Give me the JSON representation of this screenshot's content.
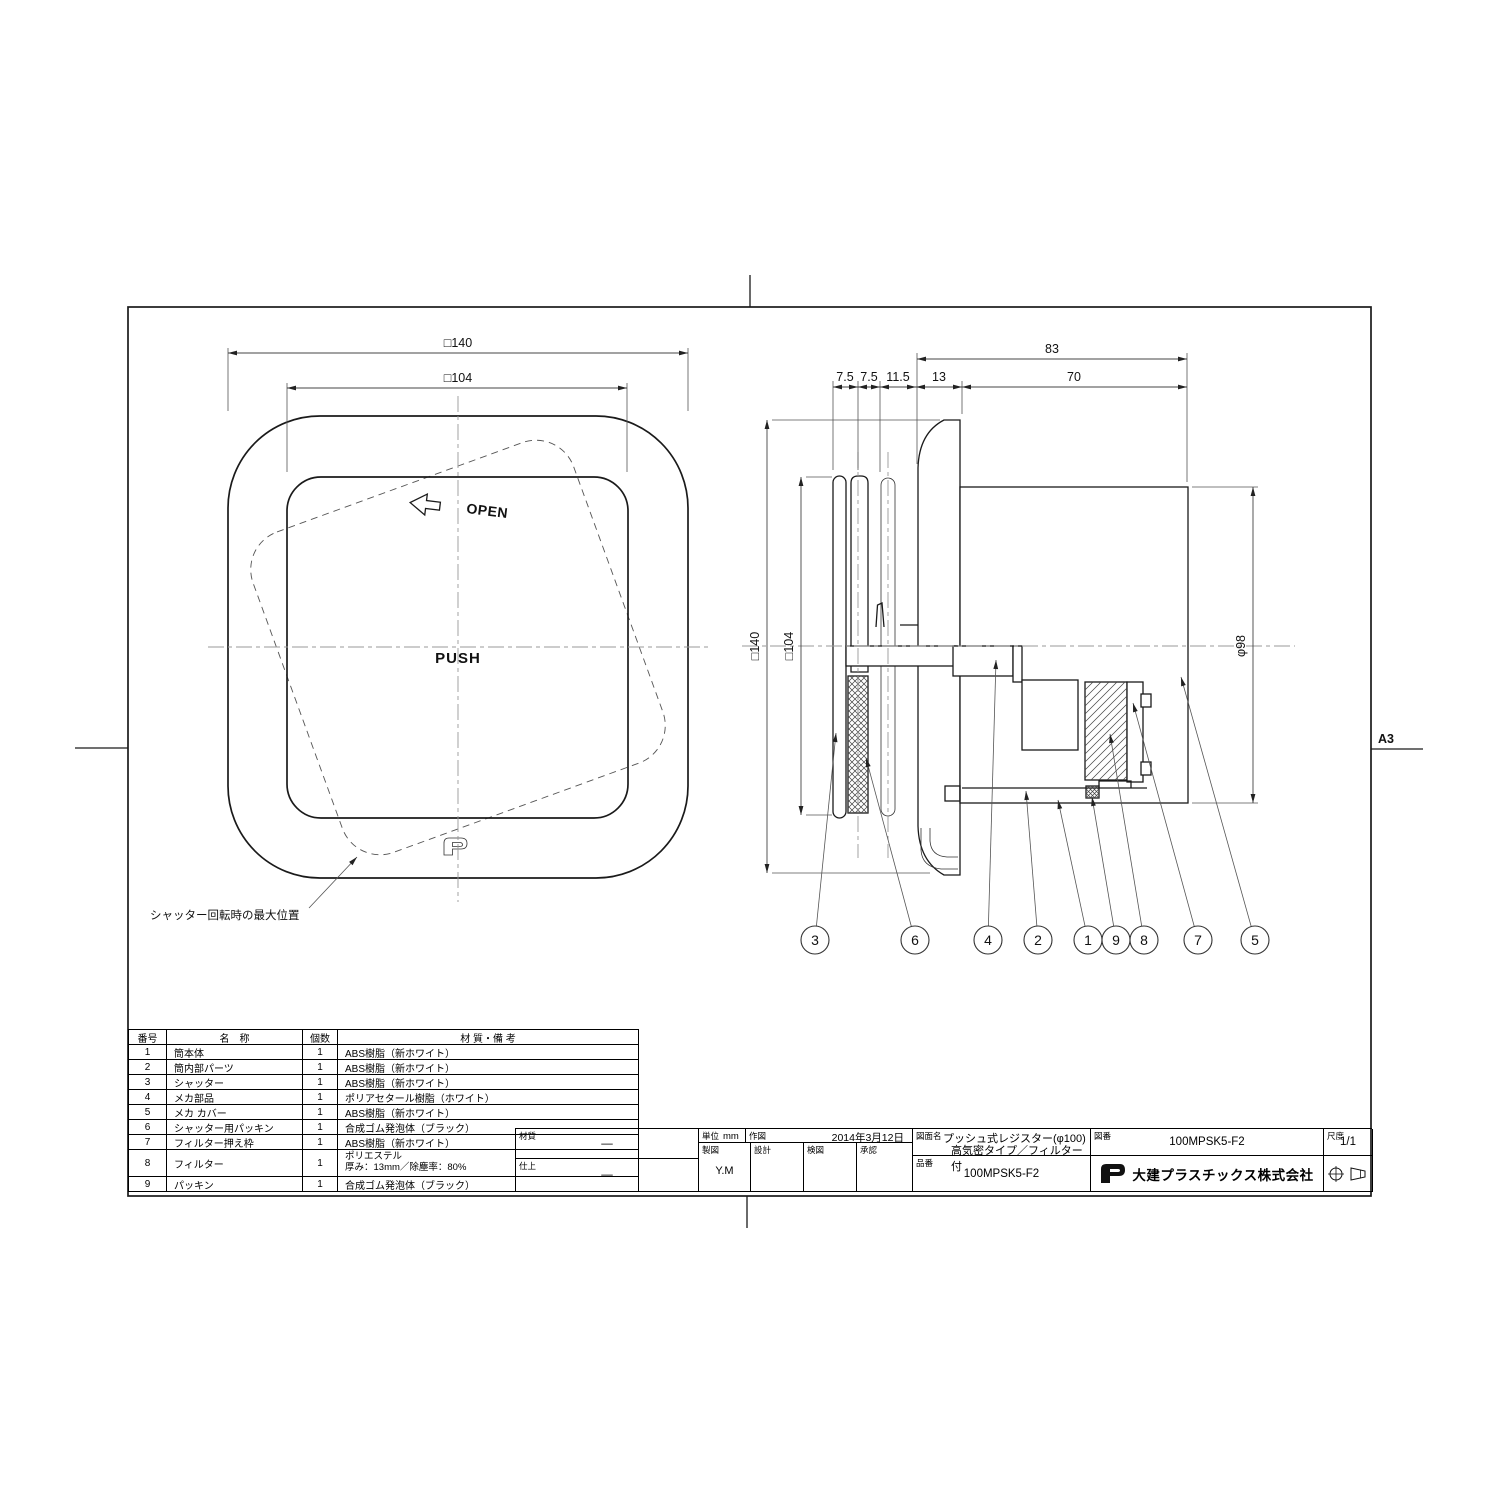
{
  "sheet": {
    "size_label": "A3"
  },
  "front_view": {
    "dim_outer": "□140",
    "dim_inner": "□104",
    "open_label": "OPEN",
    "push_label": "PUSH",
    "note_shutter": "シャッター回転時の最大位置"
  },
  "side_view": {
    "dim_total": "83",
    "dims_chain": [
      "7.5",
      "7.5",
      "11.5",
      "13",
      "70"
    ],
    "dim_outer": "□140",
    "dim_inner": "□104",
    "dim_diameter": "φ98",
    "balloons": [
      "3",
      "6",
      "4",
      "2",
      "1",
      "9",
      "8",
      "7",
      "5"
    ]
  },
  "parts_table": {
    "headers": [
      "番号",
      "名　称",
      "個数",
      "材 質・備 考"
    ],
    "rows": [
      [
        "1",
        "筒本体",
        "1",
        "ABS樹脂（新ホワイト）"
      ],
      [
        "2",
        "筒内部パーツ",
        "1",
        "ABS樹脂（新ホワイト）"
      ],
      [
        "3",
        "シャッター",
        "1",
        "ABS樹脂（新ホワイト）"
      ],
      [
        "4",
        "メカ部品",
        "1",
        "ポリアセタール樹脂（ホワイト）"
      ],
      [
        "5",
        "メカ カバー",
        "1",
        "ABS樹脂（新ホワイト）"
      ],
      [
        "6",
        "シャッター用パッキン",
        "1",
        "合成ゴム発泡体（ブラック）"
      ],
      [
        "7",
        "フィルター押え枠",
        "1",
        "ABS樹脂（新ホワイト）"
      ],
      [
        "8",
        "フィルター",
        "1",
        "ポリエステル\n厚み：13mm／除塵率：80%"
      ],
      [
        "9",
        "パッキン",
        "1",
        "合成ゴム発泡体（ブラック）"
      ]
    ]
  },
  "title_block": {
    "material_label": "材質",
    "material_value": "—",
    "finish_label": "仕上",
    "finish_value": "—",
    "unit_label": "単位",
    "unit_value": "mm",
    "drawn_label": "作図",
    "drawn_date": "2014年3月12日",
    "drafting_label": "製図",
    "drafting_value": "Y.M",
    "design_label": "設計",
    "check_label": "検図",
    "approval_label": "承認",
    "name_label": "図面名",
    "name_line1": "プッシュ式レジスター(φ100)",
    "name_line2": "高気密タイプ／フィルター付",
    "part_no_label": "品番",
    "part_no": "100MPSK5-F2",
    "drawing_no_label": "図番",
    "drawing_no": "100MPSK5-F2",
    "scale_label": "尺度",
    "scale_value": "1/1",
    "company": "大建プラスチックス株式会社"
  }
}
